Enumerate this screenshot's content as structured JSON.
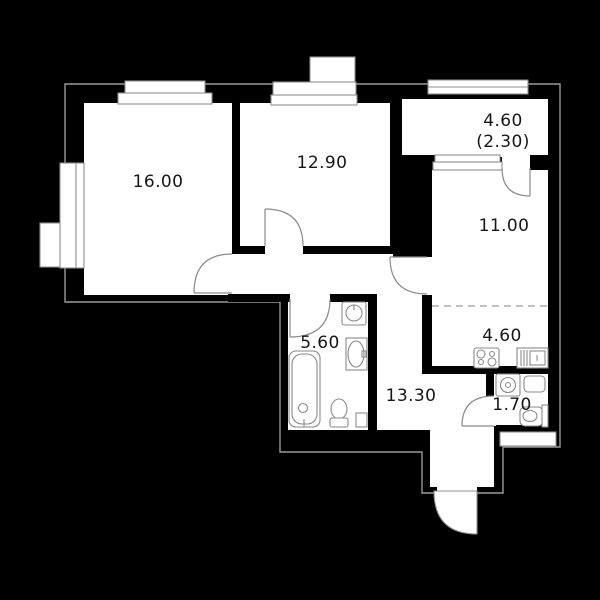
{
  "plan": {
    "type": "apartment-floor-plan",
    "rooms": [
      {
        "id": "living",
        "label": "16.00"
      },
      {
        "id": "bedroom",
        "label": "12.90"
      },
      {
        "id": "balcony",
        "label": "4.60",
        "label_secondary": "(2.30)"
      },
      {
        "id": "living-kitchen",
        "label": "11.00"
      },
      {
        "id": "kitchen-zone",
        "label": "4.60"
      },
      {
        "id": "bathroom",
        "label": "5.60"
      },
      {
        "id": "hallway",
        "label": "13.30"
      },
      {
        "id": "wc",
        "label": "1.70"
      }
    ],
    "colors": {
      "background": "#000000",
      "floor": "#ffffff",
      "wall": "#000000",
      "thin_line": "#8f8f8f",
      "label_text": "#161616"
    }
  }
}
